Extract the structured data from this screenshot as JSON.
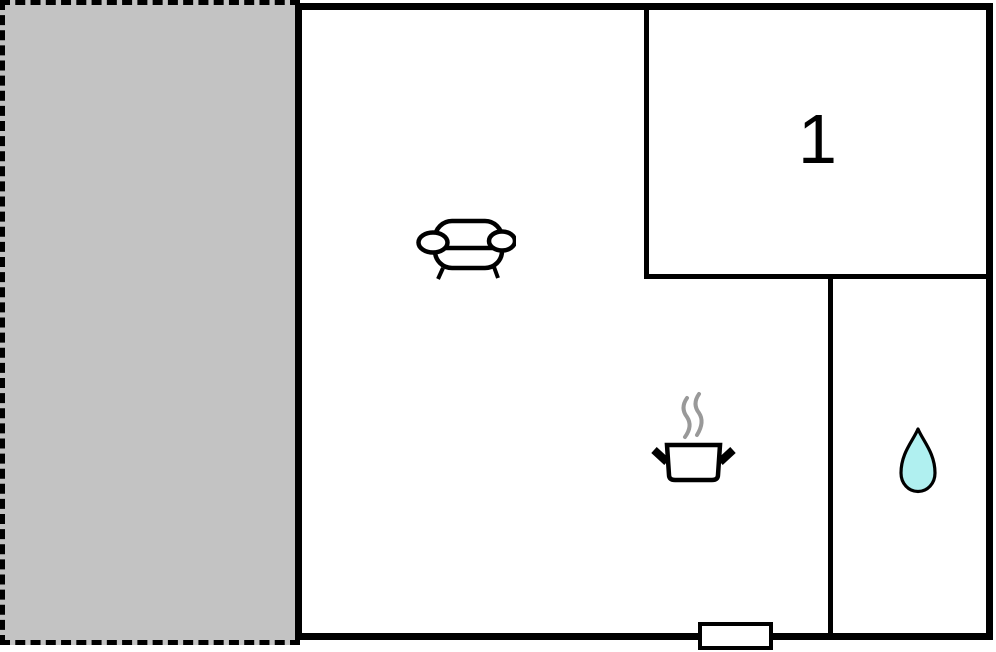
{
  "floor_plan": {
    "room1_label": "1",
    "colors": {
      "wall": "#000000",
      "terrace_fill": "#c3c3c3",
      "building_fill": "#ffffff",
      "steam": "#999999",
      "water_drop_fill": "#b0f0f0"
    },
    "icons": [
      "sofa-icon",
      "cooking-pot-icon",
      "water-drop-icon"
    ]
  }
}
